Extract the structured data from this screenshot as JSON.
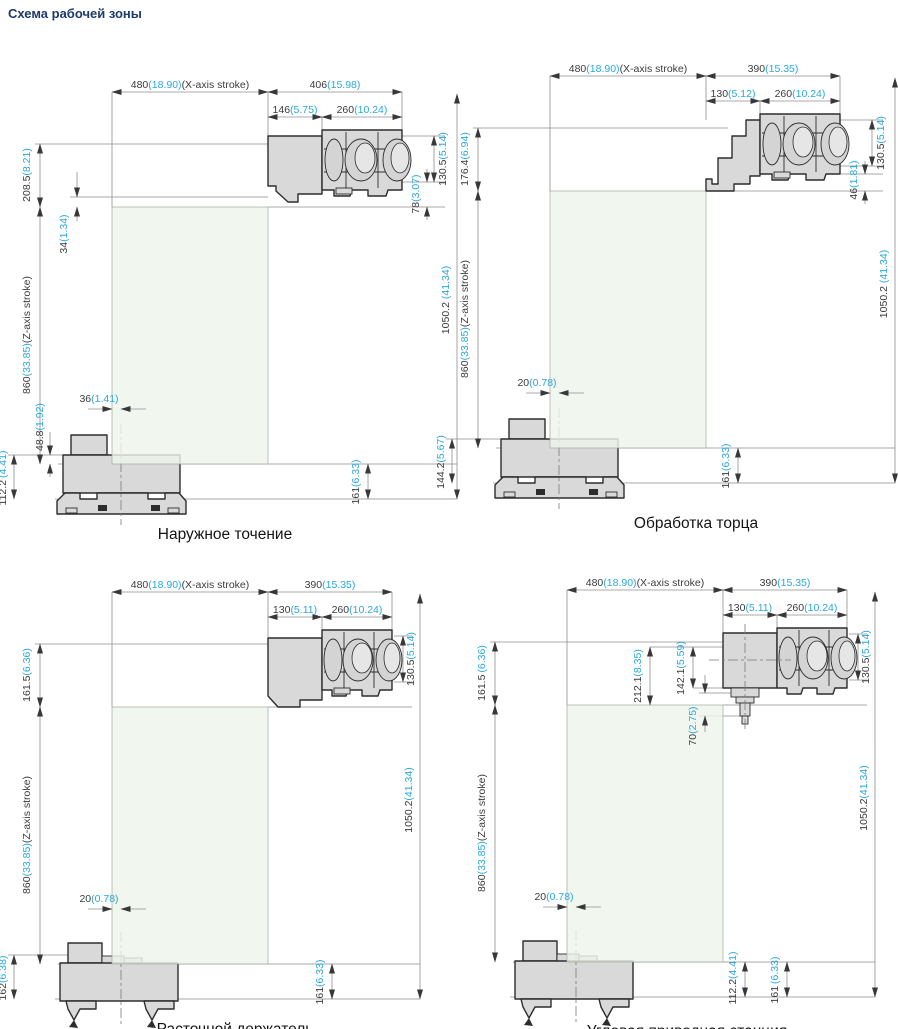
{
  "page": {
    "title": "Схема рабочей зоны"
  },
  "colors": {
    "inch_accent": "#29a8dc",
    "dim_text": "#3c3c3c",
    "title": "#1d3a6d",
    "zone_fill": "#eef4ea",
    "part_fill": "#d9d9d9",
    "outline": "#2d2d2d"
  },
  "panels": [
    {
      "caption": "Наружное точение",
      "dims": {
        "xstroke": {
          "mm": "480",
          "in": "(18.90)",
          "sfx": "(X-axis stroke)"
        },
        "width": {
          "mm": "406",
          "in": "(15.98)"
        },
        "sub1": {
          "mm": "146",
          "in": "(5.75)"
        },
        "sub2": {
          "mm": "260",
          "in": "(10.24)"
        },
        "left_top": {
          "mm": "208.5",
          "in": "(8.21)"
        },
        "d34": {
          "mm": "34",
          "in": "(1.34)"
        },
        "zstroke": {
          "mm": "860",
          "in": "(33.85)",
          "sfx": "(Z-axis stroke)"
        },
        "offset": {
          "mm": "36",
          "in": "(1.41)"
        },
        "d488": {
          "mm": "48.8",
          "in": "(1.92)"
        },
        "base_left": {
          "mm": "112.2",
          "in": "(4.41)"
        },
        "r130": {
          "mm": "130.5",
          "in": "(5.14)"
        },
        "r2": {
          "mm": "78",
          "in": "(3.07)"
        },
        "total": {
          "mm": "1050.2",
          "in": "(41.34)"
        },
        "d161": {
          "mm": "161",
          "in": "(6.33)"
        }
      }
    },
    {
      "caption": "Обработка торца",
      "dims": {
        "xstroke": {
          "mm": "480",
          "in": "(18.90)",
          "sfx": "(X-axis stroke)"
        },
        "width": {
          "mm": "390",
          "in": "(15.35)"
        },
        "sub1": {
          "mm": "130",
          "in": "(5.12)"
        },
        "sub2": {
          "mm": "260",
          "in": "(10.24)"
        },
        "left_top": {
          "mm": "176.4",
          "in": "(6.94)"
        },
        "zstroke": {
          "mm": "860",
          "in": "(33.85)",
          "sfx": "(Z-axis stroke)"
        },
        "offset": {
          "mm": "20",
          "in": "(0.78)"
        },
        "base_left": {
          "mm": "144.2",
          "in": "(5.67)"
        },
        "r130": {
          "mm": "130.5",
          "in": "(5.14)"
        },
        "r2": {
          "mm": "46",
          "in": "(1.81)"
        },
        "total": {
          "mm": "1050.2",
          "in": "(41.34)"
        },
        "d161": {
          "mm": "161",
          "in": "(6.33)"
        }
      }
    },
    {
      "caption": "Расточной держатель",
      "dims": {
        "xstroke": {
          "mm": "480",
          "in": "(18.90)",
          "sfx": "(X-axis stroke)"
        },
        "width": {
          "mm": "390",
          "in": "(15.35)"
        },
        "sub1": {
          "mm": "130",
          "in": "(5.11)"
        },
        "sub2": {
          "mm": "260",
          "in": "(10.24)"
        },
        "left_top": {
          "mm": "161.5",
          "in": "(6.36)"
        },
        "zstroke": {
          "mm": "860",
          "in": "(33.85)",
          "sfx": "(Z-axis stroke)"
        },
        "offset": {
          "mm": "20",
          "in": "(0.78)"
        },
        "base_left": {
          "mm": "162",
          "in": "(6.38)"
        },
        "r130": {
          "mm": "130.5",
          "in": "(5.14)"
        },
        "total": {
          "mm": "1050.2",
          "in": "(41.34)"
        },
        "d161": {
          "mm": "161",
          "in": "(6.33)"
        }
      }
    },
    {
      "caption": "Угловая приводная станция",
      "dims": {
        "xstroke": {
          "mm": "480",
          "in": "(18.90)",
          "sfx": "(X-axis stroke)"
        },
        "width": {
          "mm": "390",
          "in": "(15.35)"
        },
        "sub1": {
          "mm": "130",
          "in": "(5.11)"
        },
        "sub2": {
          "mm": "260",
          "in": "(10.24)"
        },
        "left_top": {
          "mm": "161.5",
          "in": "(6.36)"
        },
        "zstroke": {
          "mm": "860",
          "in": "(33.85)",
          "sfx": "(Z-axis stroke)"
        },
        "offset": {
          "mm": "20",
          "in": "(0.78)"
        },
        "m212": {
          "mm": "212.1",
          "in": "(8.35)"
        },
        "m142": {
          "mm": "142.1",
          "in": "(5.59)"
        },
        "m70": {
          "mm": "70",
          "in": "(2.75)"
        },
        "r130": {
          "mm": "130.5",
          "in": "(5.14)"
        },
        "total": {
          "mm": "1050.2",
          "in": "(41.34)"
        },
        "base_mid": {
          "mm": "112.2",
          "in": "(4.41)"
        },
        "d161": {
          "mm": "161",
          "in": "(6.33)"
        }
      }
    }
  ]
}
